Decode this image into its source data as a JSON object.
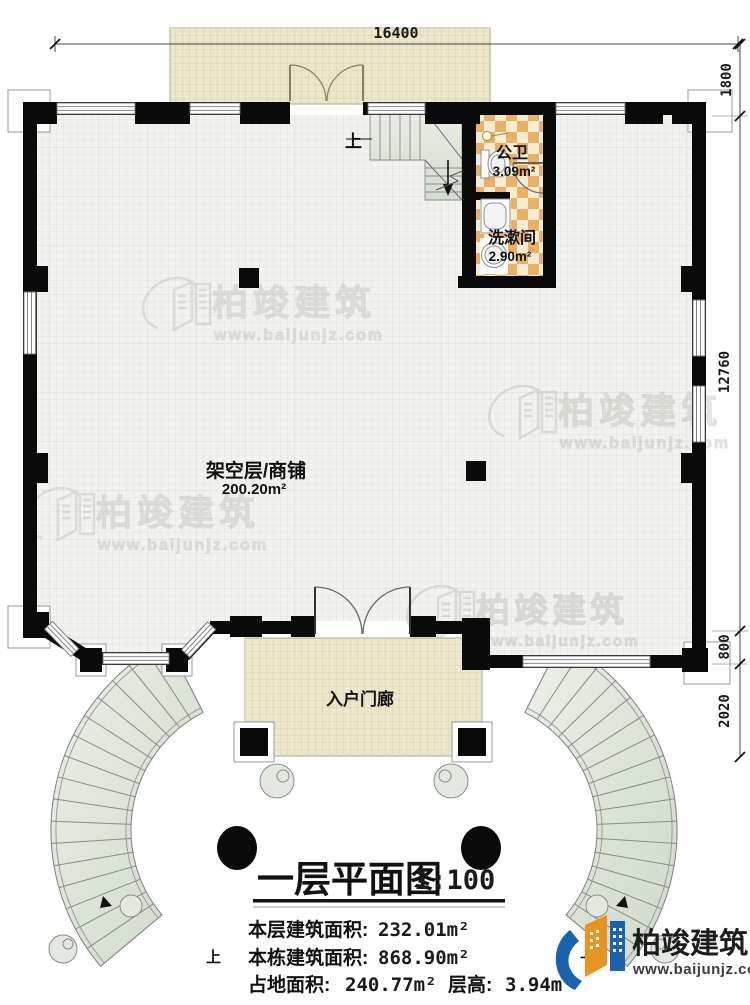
{
  "plan": {
    "dimensions": {
      "top": "16400",
      "right_top": "1800",
      "right_main": "12760",
      "right_lower": "800",
      "right_bottom": "2020"
    },
    "rooms": {
      "main": {
        "name": "架空层/商铺",
        "area": "200.20m²"
      },
      "toilet": {
        "name": "公卫",
        "area": "3.09m²"
      },
      "washroom": {
        "name": "洗漱间",
        "area": "2.90m²"
      },
      "entry_porch": {
        "name": "入户门廊"
      }
    },
    "stairs": {
      "up_label": "上"
    }
  },
  "title_block": {
    "title": "一层平面图",
    "scale": "1:100",
    "stats": [
      {
        "label": "本层建筑面积:",
        "value": "232.01m²"
      },
      {
        "label": "本栋建筑面积:",
        "value": "868.90m²"
      },
      {
        "label": "占地面积:",
        "value": "240.77m²"
      },
      {
        "label": "层高:",
        "value": "3.94m"
      }
    ]
  },
  "branding": {
    "logo_text": "柏竣建筑",
    "logo_url": "www.baijunjz.com",
    "watermark_text": "柏竣建筑",
    "watermark_url": "www.baijunjz.com",
    "colors": {
      "wall_black": "#0a0a0a",
      "porch_tan": "#ece6cb",
      "checker_orange": "#e9b163",
      "stair_green": "#dfe6db",
      "logo_blue": "#1a63b0",
      "logo_orange": "#e8941f"
    }
  }
}
